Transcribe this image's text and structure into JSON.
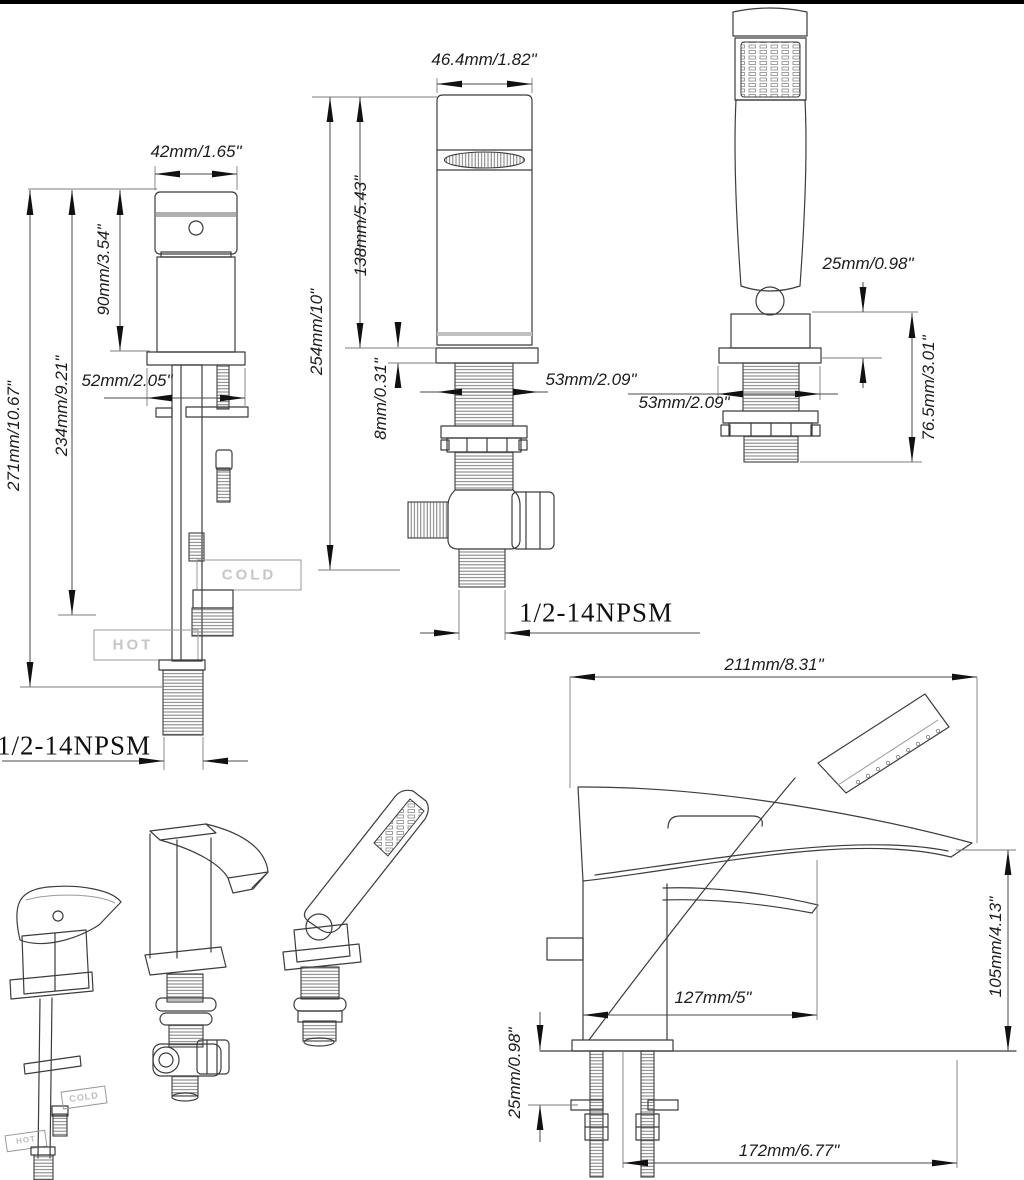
{
  "dims": {
    "valve": {
      "handle_width": "42mm/1.65\"",
      "handle_height": "90mm/3.54\"",
      "escutcheon_width": "52mm/2.05\"",
      "body_height": "234mm/9.21\"",
      "total_height": "271mm/10.67\"",
      "thread_spec": "1/2-14NPSM"
    },
    "spout": {
      "top_width": "46.4mm/1.82\"",
      "body_height": "138mm/5.43\"",
      "total_height": "254mm/10\"",
      "flange_thickness": "8mm/0.31\"",
      "flange_width": "53mm/2.09\"",
      "thread_spec": "1/2-14NPSM"
    },
    "handshower": {
      "ball_offset": "25mm/0.98\"",
      "flange_width": "53mm/2.09\"",
      "below_deck_height": "76.5mm/3.01\""
    },
    "assembled": {
      "spout_reach": "211mm/8.31\"",
      "spout_height": "105mm/4.13\"",
      "handle_center": "127mm/5\"",
      "deck_thickness": "25mm/0.98\"",
      "outlet_offset": "172mm/6.77\""
    }
  },
  "labels": {
    "cold": "COLD",
    "hot": "HOT"
  }
}
